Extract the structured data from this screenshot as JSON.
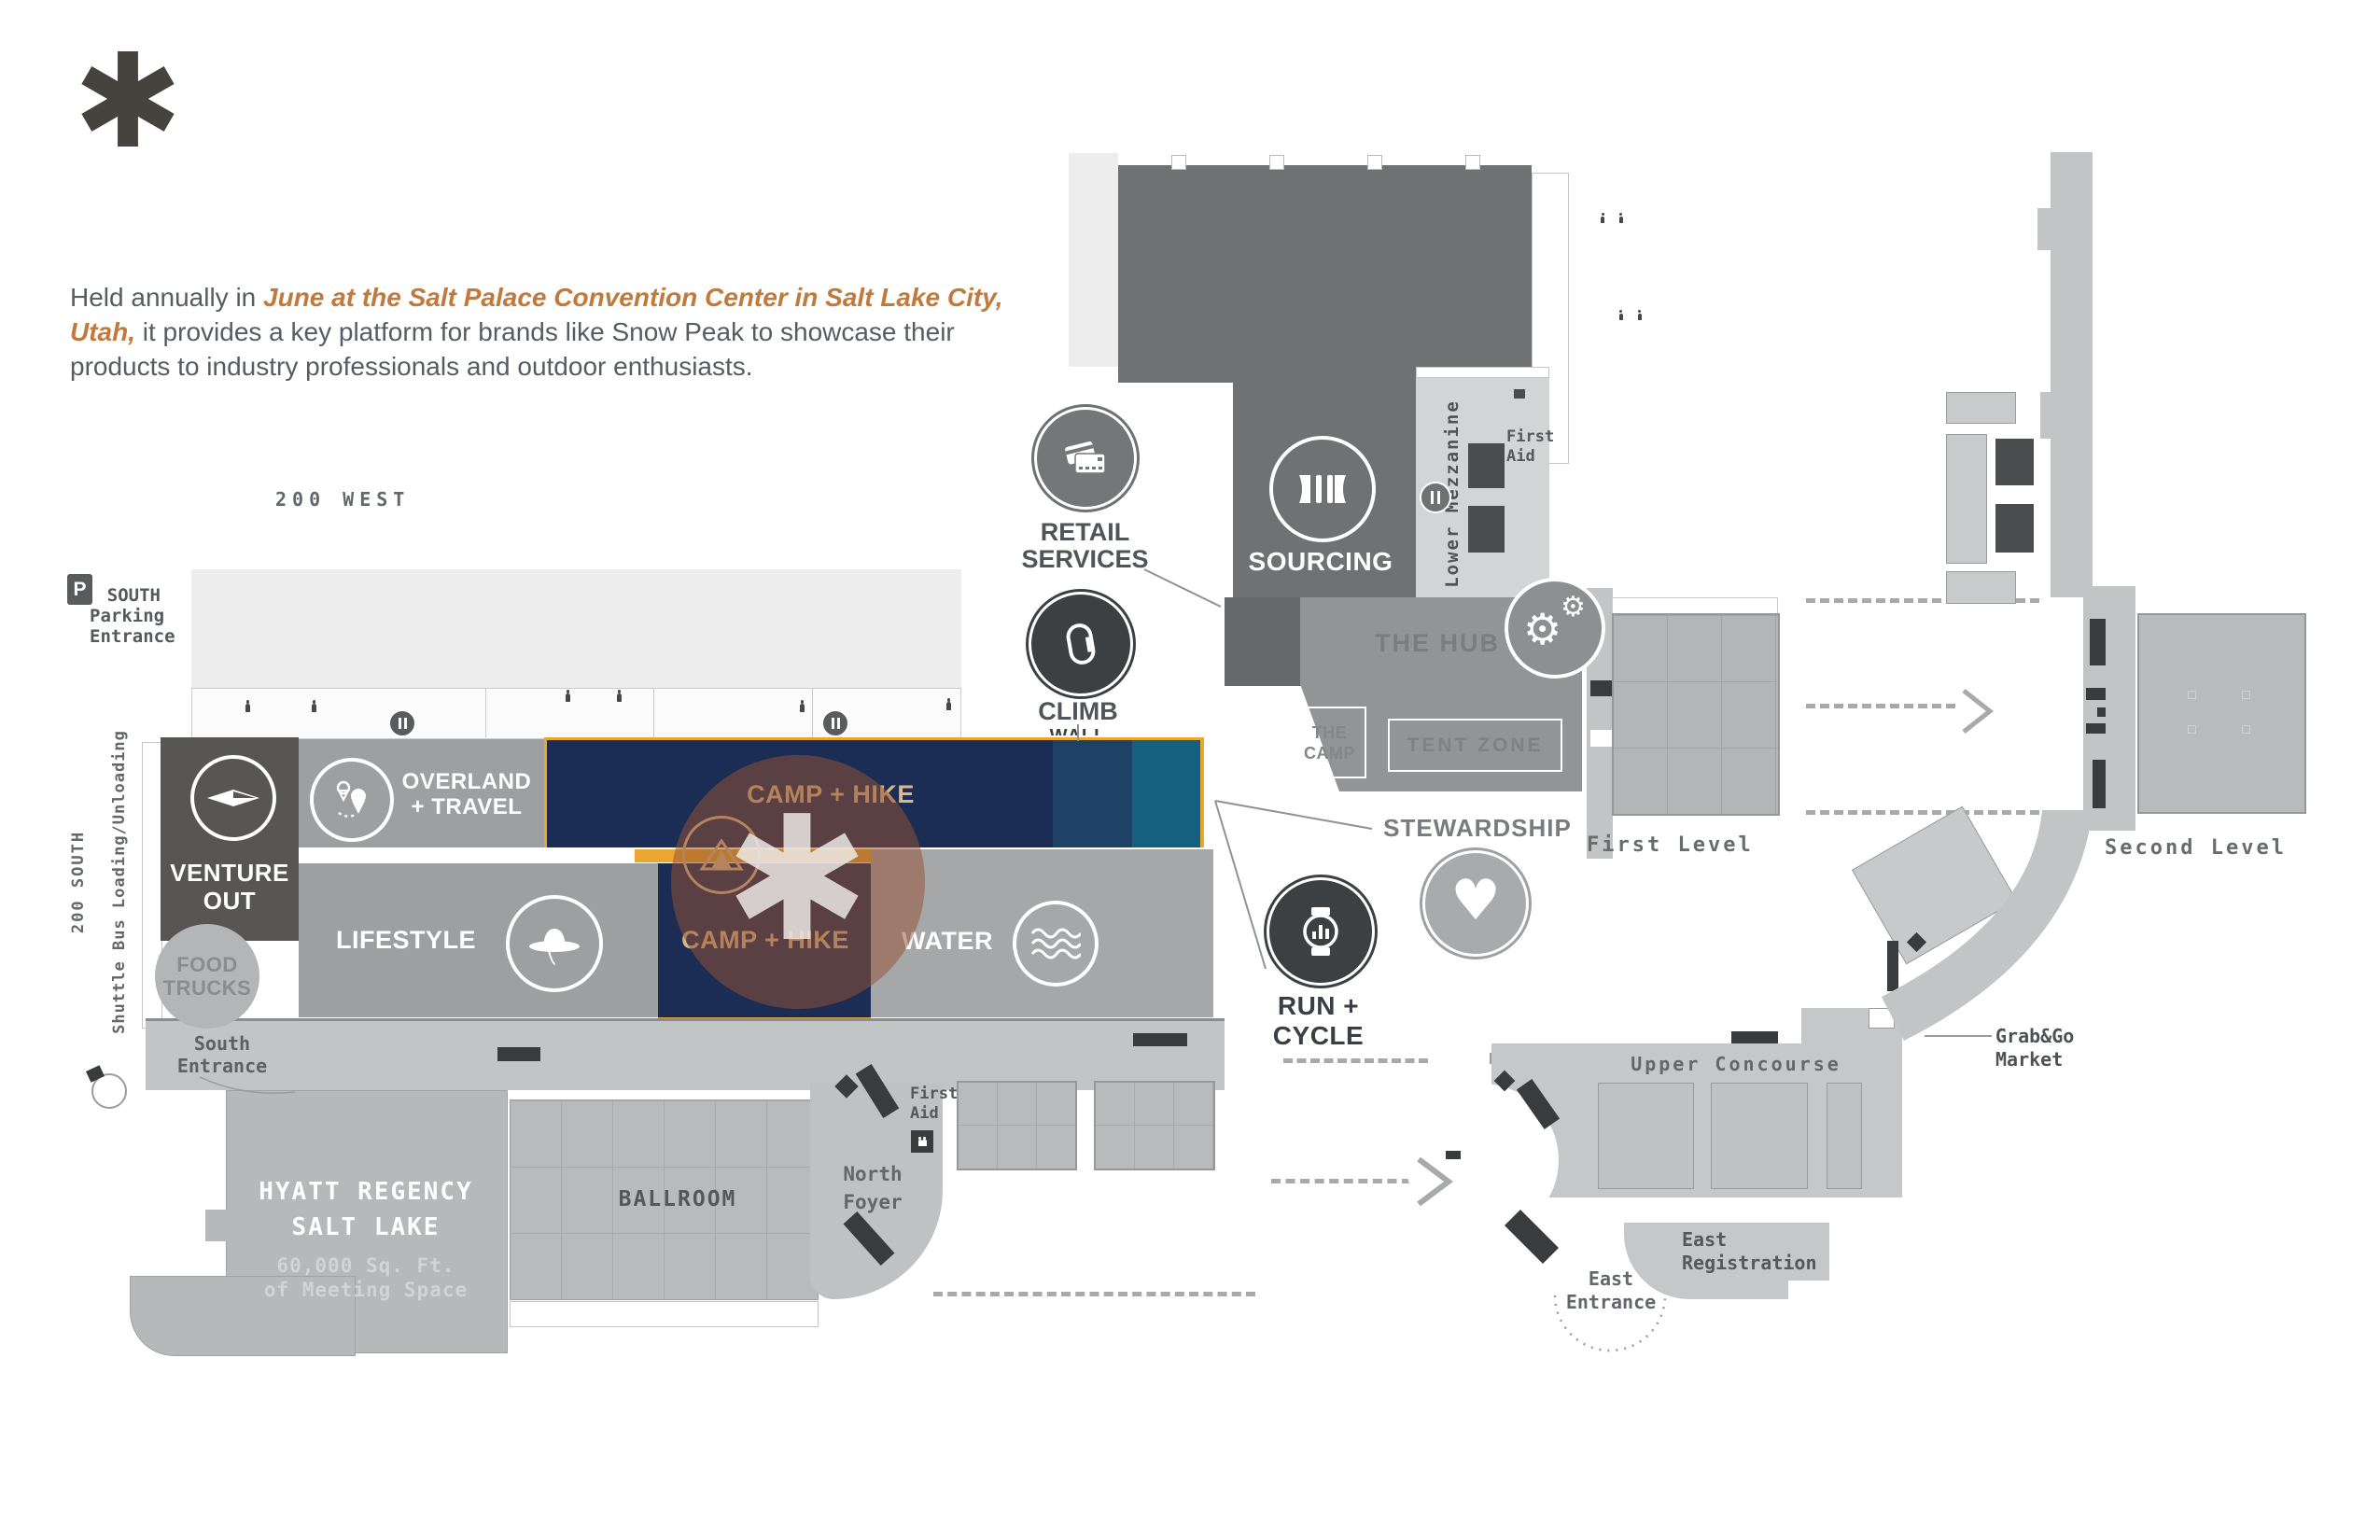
{
  "logo": {
    "glyph": "✱"
  },
  "intro": {
    "pre": "Held annually in ",
    "highlight": "June at the Salt Palace Convention Center in Salt Lake City, Utah,",
    "post": " it provides a key platform for brands like Snow Peak to showcase their products to industry professionals and outdoor enthusiasts."
  },
  "streets": {
    "west": "200 WEST",
    "south": "200 SOUTH",
    "shuttle": "Shuttle Bus Loading/Unloading"
  },
  "parking": {
    "p": "P",
    "line1": "SOUTH",
    "line2": "Parking",
    "line3": "Entrance"
  },
  "zones": {
    "venture_out": {
      "line1": "VENTURE",
      "line2": "OUT"
    },
    "overland": {
      "line1": "OVERLAND",
      "line2": "+ TRAVEL"
    },
    "camp_hike_top": "CAMP + HIKE",
    "camp_hike_bottom": "CAMP + HIKE",
    "lifestyle": "LIFESTYLE",
    "water": "WATER",
    "climb": "CLIMB",
    "climb_partial": "WALL",
    "retail": {
      "line1": "RETAIL",
      "line2": "SERVICES"
    },
    "sourcing": "SOURCING",
    "run_cycle": "RUN + CYCLE",
    "stewardship": "STEWARDSHIP",
    "the_hub": "THE HUB",
    "the_camp": {
      "line1": "THE",
      "line2": "CAMP"
    },
    "tent_zone": "TENT ZONE",
    "food_trucks": {
      "line1": "FOOD",
      "line2": "TRUCKS"
    }
  },
  "places": {
    "first_aid": {
      "line1": "First",
      "line2": "Aid"
    },
    "lower_mezzanine": "Lower Mezzanine",
    "first_level": "First Level",
    "second_level": "Second Level",
    "upper_concourse": "Upper Concourse",
    "grab_go": {
      "line1": "Grab&Go",
      "line2": "Market"
    },
    "east_registration": {
      "line1": "East",
      "line2": "Registration"
    },
    "east_entrance": {
      "line1": "East",
      "line2": "Entrance"
    },
    "north_foyer": {
      "line1": "North",
      "line2": "Foyer"
    },
    "south_entrance": {
      "line1": "South",
      "line2": "Entrance"
    },
    "ballroom": "BALLROOM",
    "hyatt": {
      "line1": "HYATT REGENCY",
      "line2": "SALT LAKE",
      "line3": "60,000 Sq. Ft.",
      "line4": "of Meeting Space"
    }
  },
  "glyphs": {
    "asterisk": "✱",
    "gear": "⚙",
    "heart": "♥"
  },
  "icons": {
    "logo": "asterisk-mark",
    "compass": "compass-needle",
    "route": "map-pins-route",
    "tent": "tent",
    "hat": "sun-hat",
    "waves": "water-waves",
    "carabiner": "carabiner",
    "credit_cards": "credit-cards",
    "buckle": "side-release-buckle",
    "watch": "sport-watch",
    "gears": "gears",
    "handshake": "handshake-heart",
    "dining": "fork-knife",
    "restroom": "person-figure",
    "parking": "parking-P"
  },
  "colors": {
    "navy": "#1b2c55",
    "blue_mid": "#1e4166",
    "teal": "#14607f",
    "yellow": "#eaa62f",
    "tan_label": "#d8b98c",
    "dark_hall": "#6f7173",
    "zone_gray": "#9e9fa0",
    "venture_gray": "#575654",
    "map_gray": "#c3c4c5",
    "block_gray": "#b9babb",
    "icon_dark": "#3d4043",
    "highlight": "rgba(150,80,52,0.52)",
    "accent_text": "#c1793c",
    "body_text": "#575c63"
  }
}
